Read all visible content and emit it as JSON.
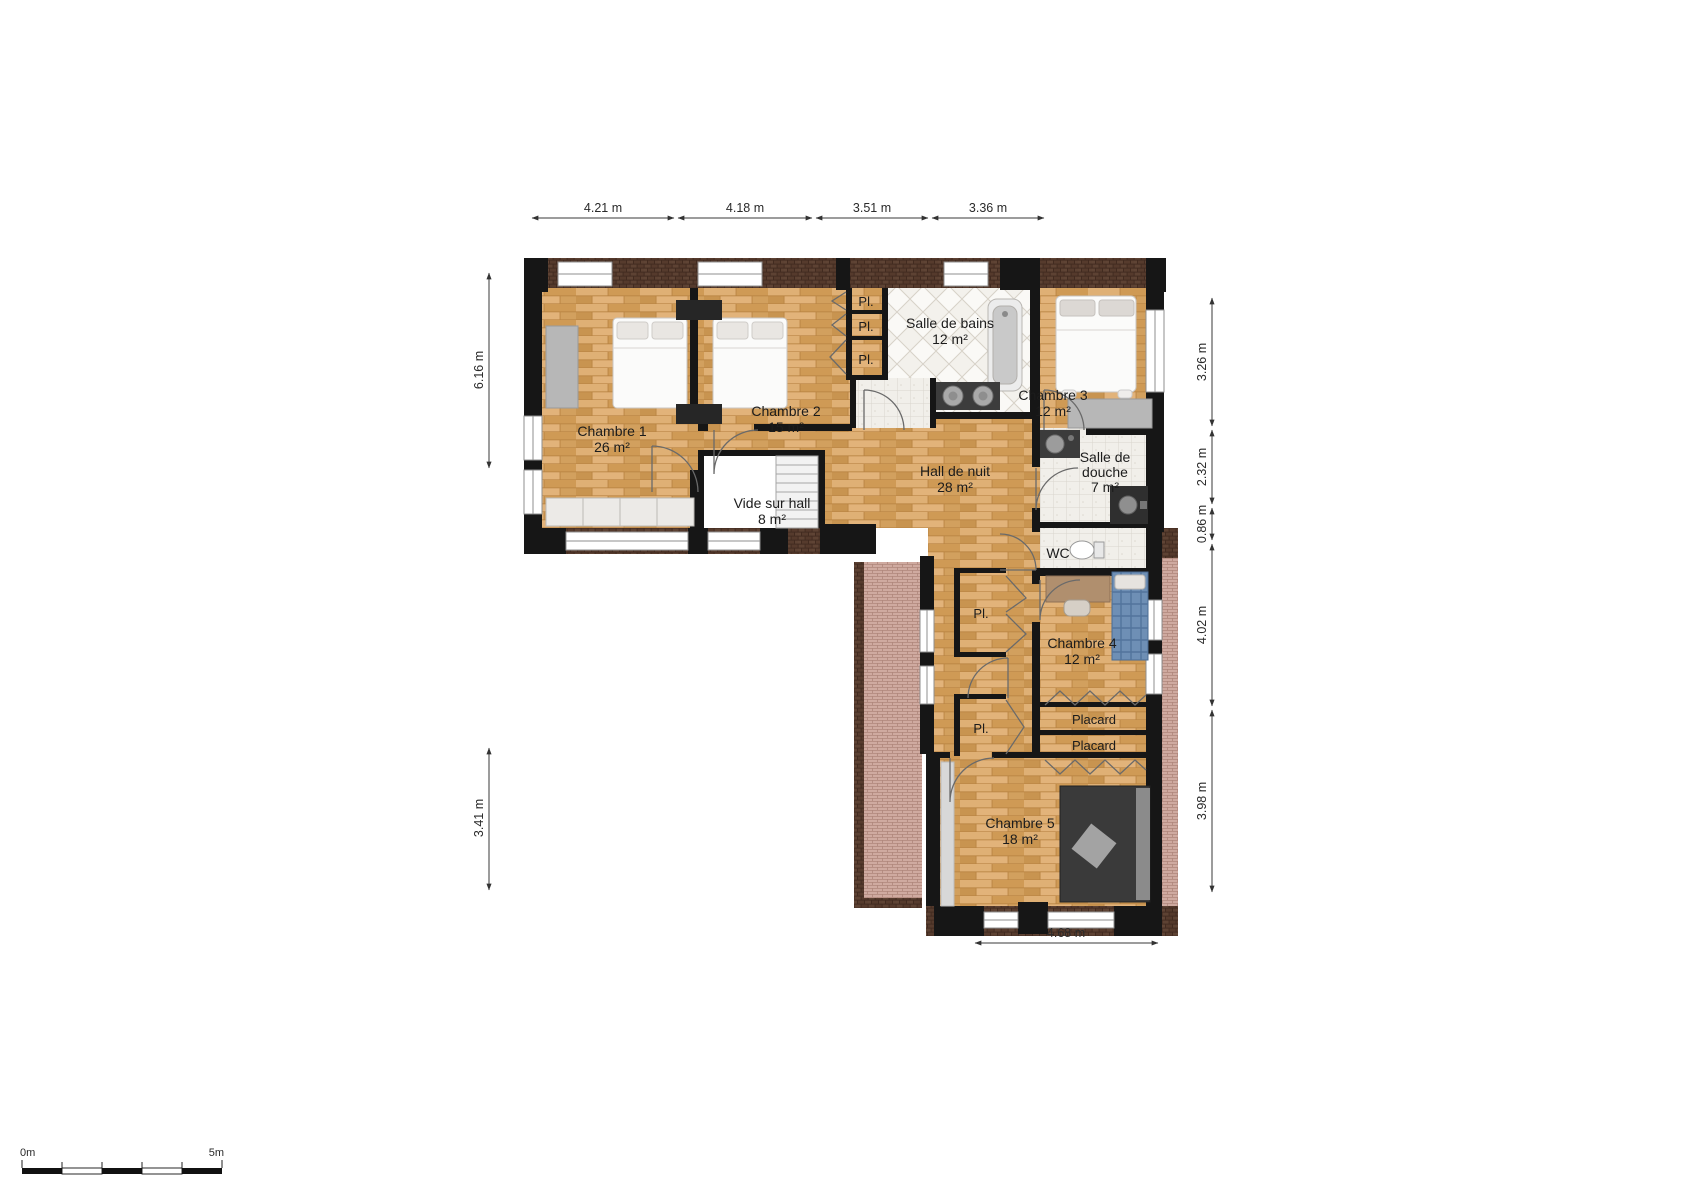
{
  "floor_plan": {
    "rooms": [
      {
        "name": "Chambre 1",
        "area": "26 m²"
      },
      {
        "name": "Chambre 2",
        "area": "15 m²"
      },
      {
        "name": "Salle de bains",
        "area": "12 m²"
      },
      {
        "name": "Chambre 3",
        "area": "12 m²"
      },
      {
        "name": "Hall de nuit",
        "area": "28 m²"
      },
      {
        "name": "Vide sur hall",
        "area": "8 m²"
      },
      {
        "name": "Salle de douche",
        "name_line1": "Salle de",
        "name_line2": "douche",
        "area": "7 m²"
      },
      {
        "name": "WC"
      },
      {
        "name": "Chambre 4",
        "area": "12 m²"
      },
      {
        "name": "Chambre 5",
        "area": "18 m²"
      }
    ],
    "closet_small_label": "Pl.",
    "closet_large_label": "Placard",
    "dimensions": {
      "top": [
        "4.21 m",
        "4.18 m",
        "3.51 m",
        "3.36 m"
      ],
      "left": [
        "6.16 m",
        "3.41 m"
      ],
      "right": [
        "3.26 m",
        "2.32 m",
        "0.86 m",
        "4.02 m",
        "3.98 m"
      ],
      "bottom": [
        "4.68 m"
      ]
    },
    "scale_bar": {
      "start_label": "0m",
      "end_label": "5m"
    },
    "colors": {
      "wood_floor": "#d6a463",
      "tile_floor": "#f3f1ec",
      "wall": "#161616",
      "exterior_brick": "#4a3226",
      "roof_hatch": "#cfaaa0",
      "background": "#ffffff"
    }
  }
}
